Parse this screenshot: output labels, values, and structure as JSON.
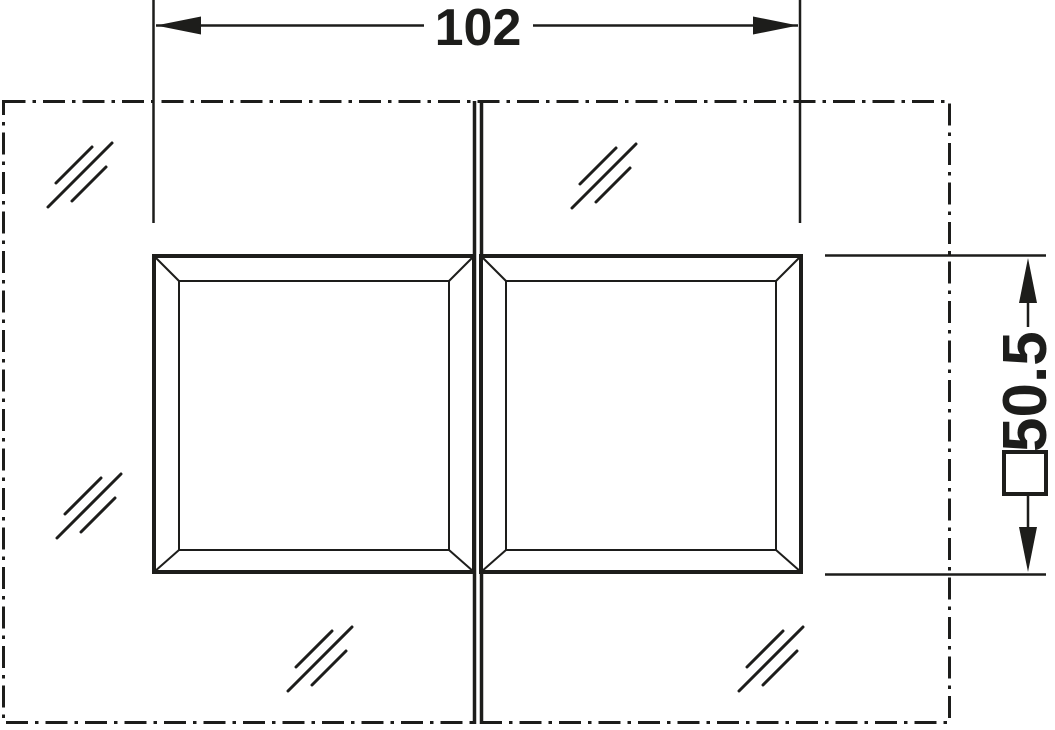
{
  "drawing": {
    "type": "technical-dimension-drawing",
    "subject": "double glass panel with two square mounting cutouts at the panel joint",
    "colors": {
      "line": "#1d1d1b",
      "background": "#ffffff"
    },
    "dimensions": {
      "width": {
        "value": "102",
        "orientation": "horizontal",
        "position": "top"
      },
      "height": {
        "value": "50.5",
        "orientation": "vertical-rotated-90-ccw",
        "position": "right",
        "symbol": "square-cutout"
      }
    },
    "symbols": {
      "glass_hatch": "glass-material-hatch (three parallel 45-degree strokes)",
      "glass_hatch_count": 5,
      "square_symbol": "□",
      "panel_outline_style": "dash-dot chain line",
      "joint": "double vertical line between left and right glass panels"
    }
  }
}
